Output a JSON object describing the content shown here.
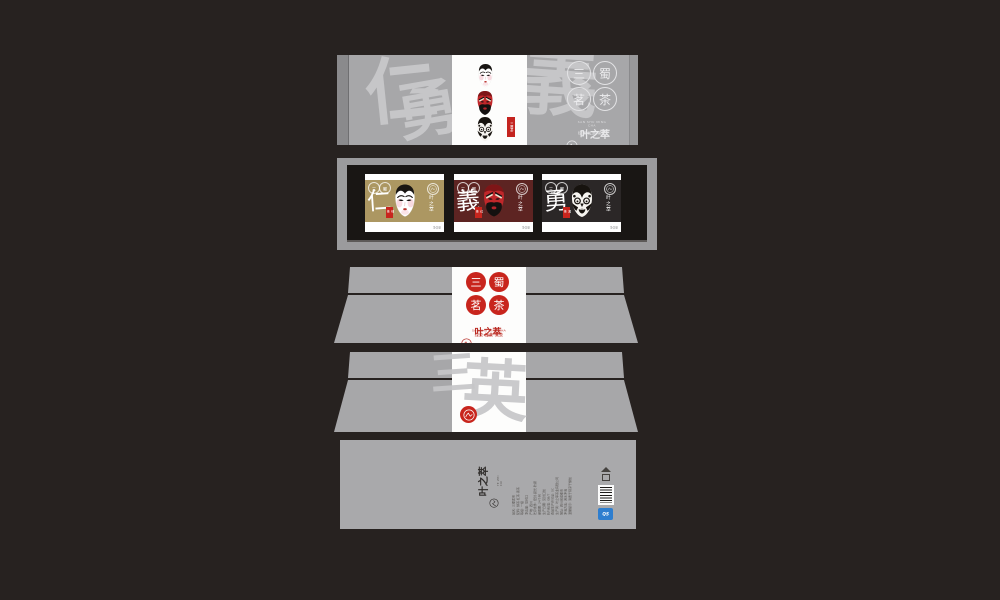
{
  "colors": {
    "page_bg": "#272220",
    "box_gray": "#a7a7a9",
    "tray_dark": "#191614",
    "seal_red": "#c8251d",
    "card_gold": "#ac9762",
    "card_maroon": "#5d2422",
    "card_black": "#2b2727",
    "watermark_gray": "#c6c6c8",
    "qs_blue": "#2e7ecf"
  },
  "brand": {
    "logo_cn": "叶之萃",
    "logo_sub": "YE ZHI CUI",
    "series_cn": [
      "三",
      "蜀",
      "茗",
      "茶"
    ],
    "series_pinyin": "SAN SHU MING CHA",
    "tea_types": "绿茶·红茶·黑茶"
  },
  "icons": {
    "brand_emblem": "mountain-in-circle-emblem",
    "opera_masks": [
      "white-face-opera-mask",
      "red-face-opera-mask",
      "black-face-opera-mask"
    ],
    "certification": "recycle-and-care-marks",
    "qs_mark": "blue-QS-certification"
  },
  "lid_top": {
    "watermark": [
      "仁",
      "義",
      "勇"
    ],
    "side_tag": "三蜀茶"
  },
  "tray": {
    "corner_seals": [
      "三",
      "蜀"
    ],
    "cards": [
      {
        "virtue": "仁",
        "tea_tag": "绿茶",
        "bg": "#ac9762",
        "mask": "white-face-opera-mask",
        "footer": "净含量"
      },
      {
        "virtue": "義",
        "tea_tag": "红茶",
        "bg": "#5d2422",
        "mask": "red-face-opera-mask",
        "footer": "净含量"
      },
      {
        "virtue": "勇",
        "tea_tag": "黑茶",
        "bg": "#2b2727",
        "mask": "black-face-opera-mask",
        "footer": "净含量"
      }
    ]
  },
  "back": {
    "watermark": [
      "三",
      "英"
    ]
  },
  "bottom": {
    "info_lines": [
      "品名: 三蜀茗茶",
      "配料: 绿茶·红茶·黑茶",
      "等级: 一级",
      "净含量: 见封口",
      "产地: 四川",
      "贮存条件: 密封·避光·防潮",
      "保质期: 24个月",
      "生产日期: 见封口处",
      "执行标准: GB/T",
      "食品生产许可证: SC",
      "生产商: 叶之萃茶业有限公司",
      "地址: 四川省成都市",
      "冲泡方法: 沸水冲泡",
      "温馨提示: 请置于阴凉干燥处"
    ],
    "qs_label": "QS"
  }
}
